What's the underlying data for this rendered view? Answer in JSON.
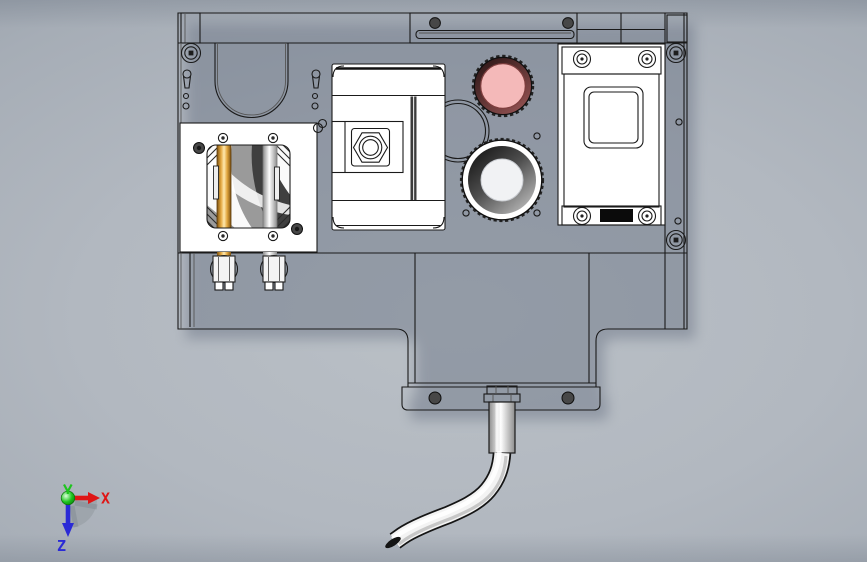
{
  "viewport": {
    "part_face": "#ffffff",
    "edge_color": "#1a1a1a",
    "shadow": "#667081",
    "background_center": "#bac0c6",
    "background_edge": "#8b939f"
  },
  "model": {
    "pink_lens": {
      "ring_start": "#241111",
      "ring_end": "#935252",
      "glass": "#f4b9b9"
    },
    "main_lens": {
      "ring_start": "#0c0c0c",
      "ring_end": "#bcbcbc",
      "glass": "#f1f2f4"
    },
    "gold_rod": {
      "edge": "#7c5212",
      "mid": "#e2a63e",
      "light": "#ffe9ae"
    },
    "silver_rod": {
      "edge": "#8d8d8d",
      "light": "#ffffff"
    },
    "window_dark": "#3f3f3f",
    "window_mid": "#9a9a9a",
    "dark_screw": "#474747",
    "port": "#0b0b0b",
    "cable": {
      "outline": "#151515",
      "body": "#f3f3f3",
      "shade": "#c2c2c2",
      "tip": "#141414"
    }
  },
  "triad": {
    "x_label": "X",
    "z_label": "Z",
    "x_color": "#df1616",
    "y_color": "#1fc41f",
    "z_color": "#2a2ad6",
    "shadow": "#9ba1a9"
  }
}
